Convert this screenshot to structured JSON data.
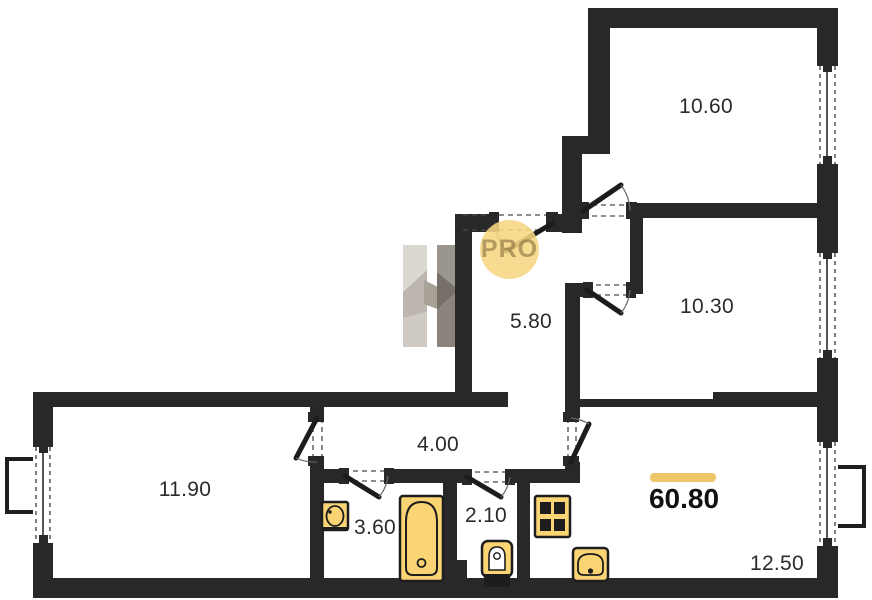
{
  "plan": {
    "watermark_text": "PRO",
    "total_area_label": "60.80",
    "rooms": [
      {
        "name": "bedroom-top",
        "area_label": "10.60"
      },
      {
        "name": "bedroom-right",
        "area_label": "10.30"
      },
      {
        "name": "hall",
        "area_label": "5.80"
      },
      {
        "name": "corridor",
        "area_label": "4.00"
      },
      {
        "name": "room-left",
        "area_label": "11.90"
      },
      {
        "name": "bathroom",
        "area_label": "3.60"
      },
      {
        "name": "wc",
        "area_label": "2.10"
      },
      {
        "name": "living-kitchen",
        "area_label": "12.50"
      }
    ],
    "icons": [
      "bathtub-icon",
      "bath-sink-icon",
      "toilet-icon",
      "stove-icon",
      "kitchen-sink-icon",
      "h-logo-watermark-icon",
      "pro-badge",
      "door-swing",
      "window",
      "balcony-outline"
    ],
    "colors": {
      "wall": "#282828",
      "fixture_fill": "#fbd473",
      "fixture_border": "#1d1d1d",
      "accent_bar": "#efc76b",
      "pro_circle": "rgba(246,214,130,0.88)",
      "label_text": "#2b2b2b"
    }
  }
}
